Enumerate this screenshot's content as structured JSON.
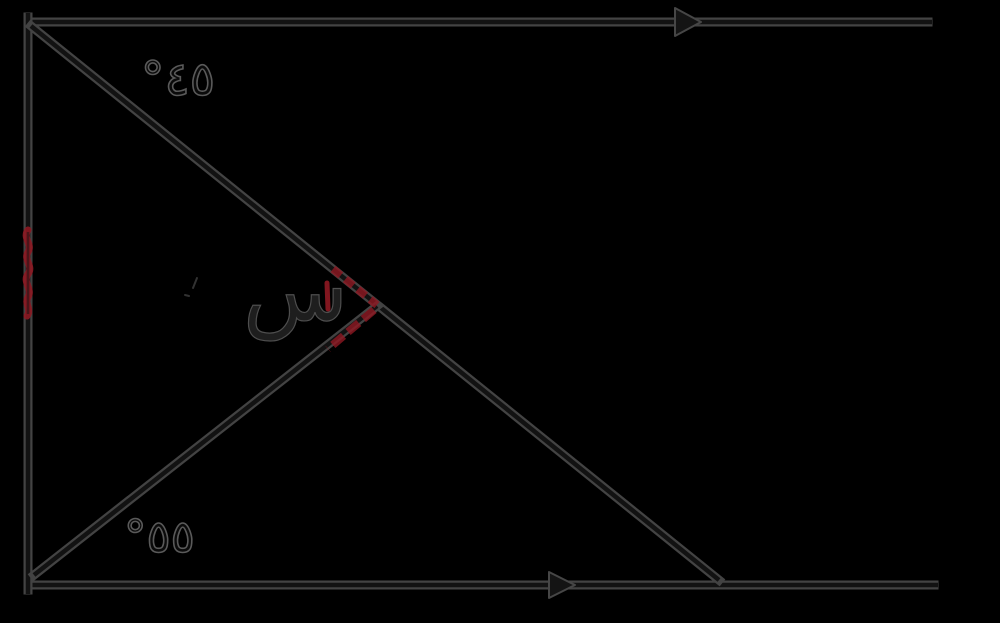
{
  "figure": {
    "top_angle_label": "°٤٥",
    "bottom_angle_label": "°٥٥",
    "unknown_angle_label": "س"
  },
  "colors": {
    "background": "#000000",
    "line_edge": "#434343",
    "line_core": "#121212",
    "arrow_fill": "#141414",
    "arrow_edge": "#464646",
    "annotation_red": "#8f1822"
  }
}
